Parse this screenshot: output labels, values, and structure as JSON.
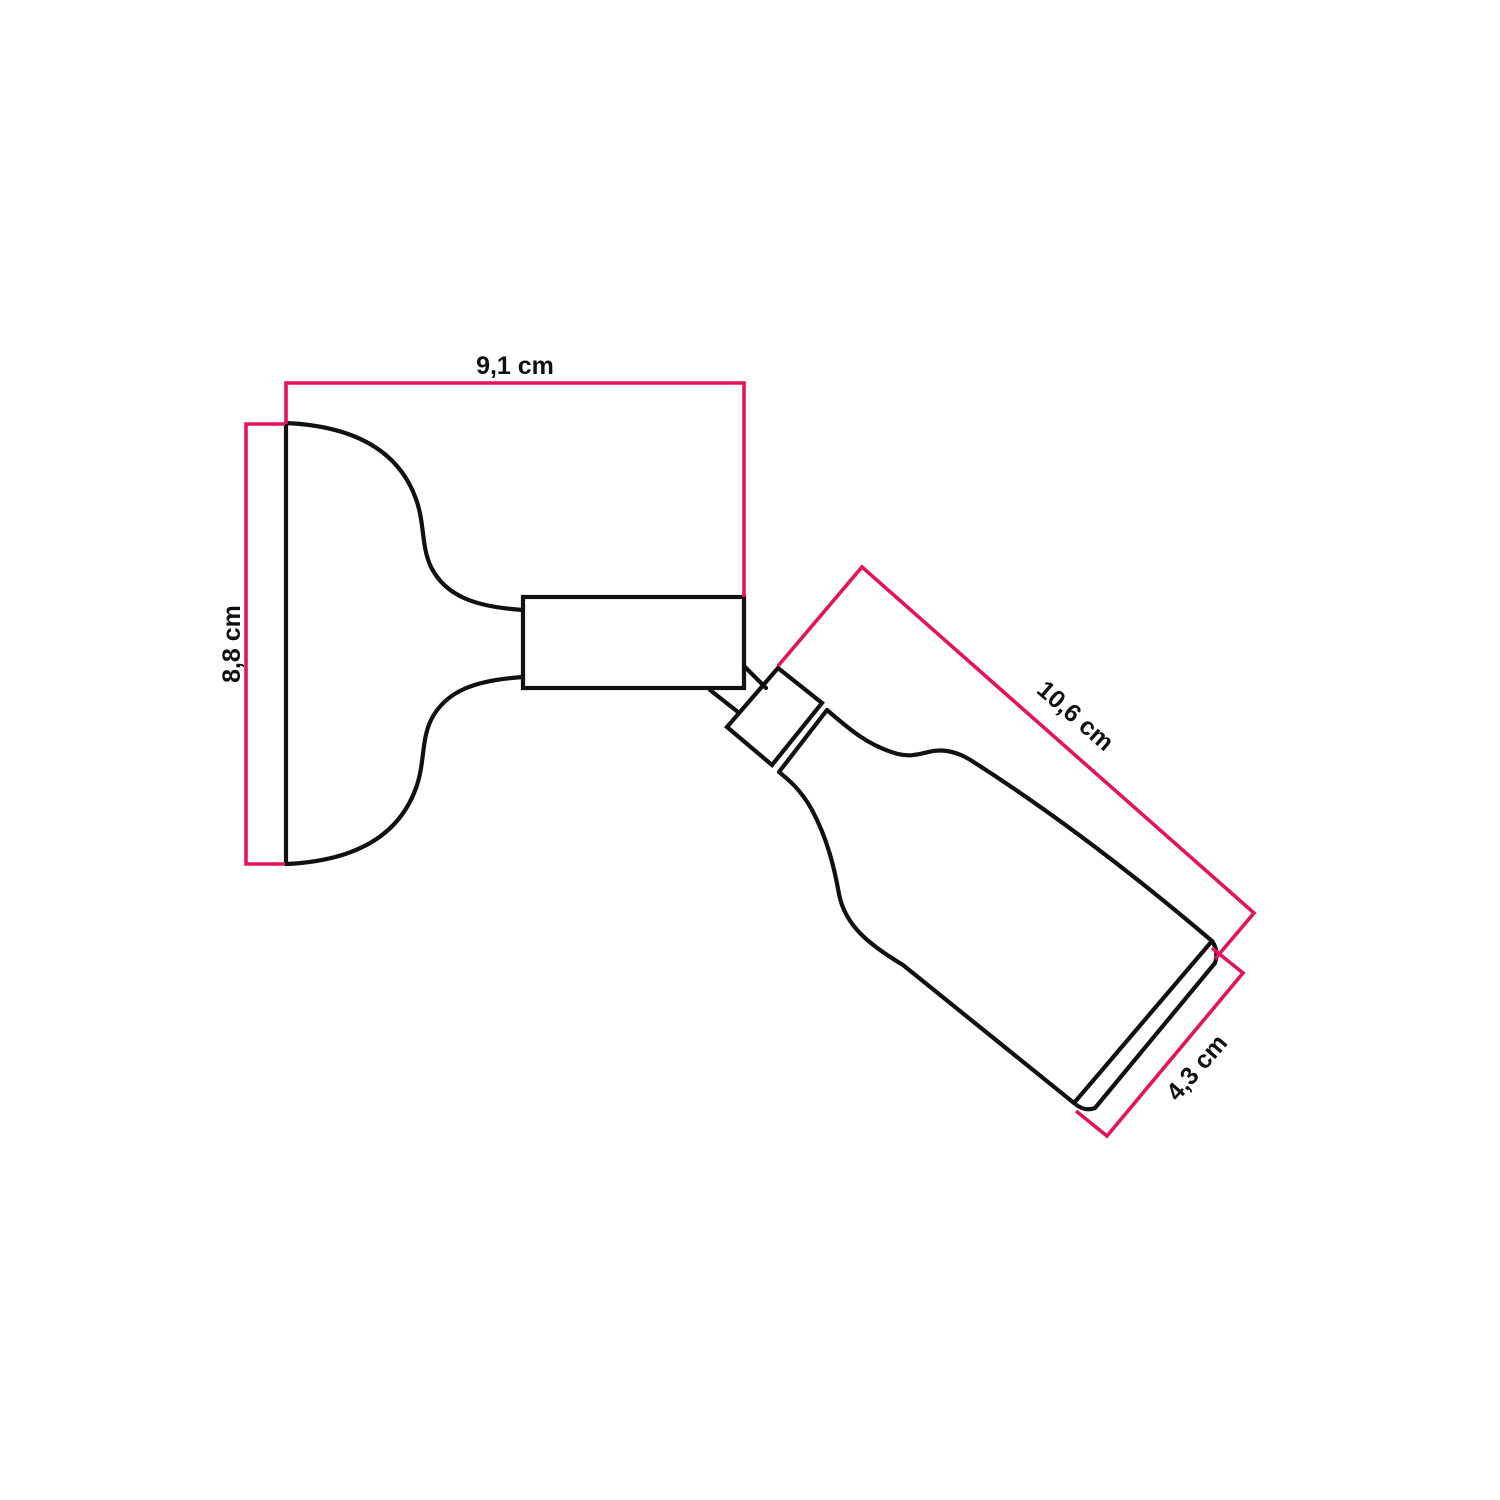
{
  "page": {
    "background_color": "#ffffff"
  },
  "diagram": {
    "kind": "technical-dimension-drawing",
    "subject": "adjustable wall lamp with swivel joint, side view",
    "outline_color": "#111111",
    "dimension_color": "#e5125c",
    "unit": "cm",
    "dimensions": [
      {
        "id": "overall-depth",
        "label": "9,1 cm",
        "value": "9,1",
        "unit": "cm",
        "orientation": "horizontal-top"
      },
      {
        "id": "base-height",
        "label": "8,8 cm",
        "value": "8,8",
        "unit": "cm",
        "orientation": "vertical-left"
      },
      {
        "id": "holder-length",
        "label": "10,6 cm",
        "value": "10,6",
        "unit": "cm",
        "orientation": "diagonal-along-holder"
      },
      {
        "id": "holder-diameter",
        "label": "4,3 cm",
        "value": "4,3",
        "unit": "cm",
        "orientation": "diagonal-across-opening"
      }
    ]
  }
}
